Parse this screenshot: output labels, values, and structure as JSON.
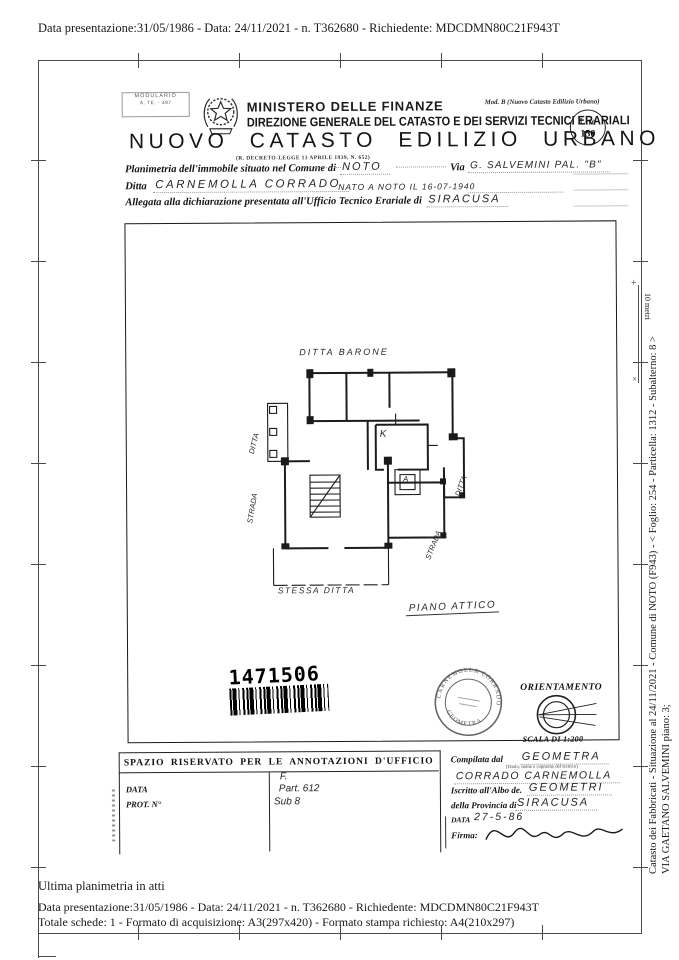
{
  "page": {
    "top_line": "Data presentazione:31/05/1986 - Data: 24/11/2021 - n. T362680 - Richiedente: MDCDMN80C21F943T",
    "bottom_line1": "Ultima planimetria in atti",
    "bottom_line2": "Data presentazione:31/05/1986 - Data: 24/11/2021 - n. T362680 - Richiedente: MDCDMN80C21F943T",
    "bottom_line3": "Totale schede: 1 - Formato di acquisizione: A3(297x420)  - Formato stampa richiesto: A4(210x297)",
    "margin_line1": "Catasto dei Fabbricati - Situazione al 24/11/2021 - Comune di NOTO (F943) - < Foglio: 254 - Particella: 1312 - Subalterno: 8 >",
    "margin_line2": "VIA GAETANO SALVEMINI piano: 3;",
    "margin_scale": "10 metri"
  },
  "header": {
    "modulario_line1": "MODULARIO",
    "modulario_line2": "A. TE. - 497",
    "ministry": "MINISTERO DELLE FINANZE",
    "direction": "DIREZIONE GENERALE DEL CATASTO E DEI SERVIZI TECNICI ERARIALI",
    "title": "NUOVO CATASTO EDILIZIO URBANO",
    "subtitle": "(R. DECRETO-LEGGE 13 APRILE 1939, N. 652)",
    "mod_b": "Mod. B (Nuovo Catasto Edilizio Urbano)",
    "lire_line1": "Lire",
    "lire_line2": "150"
  },
  "form": {
    "line1_label1": "Planimetria dell'immobile situato nel Comune di",
    "line1_value1": "NOTO",
    "line1_label2": "Via",
    "line1_value2": "G. SALVEMINI  PAL. \"B\"",
    "line2_label": "Ditta",
    "line2_value": "CARNEMOLLA  CORRADO",
    "line2_value_small": "NATO A NOTO IL 16-07-1940",
    "line3_label": "Allegata alla dichiarazione presentata all'Ufficio Tecnico Erariale di",
    "line3_value": "SIRACUSA"
  },
  "plan": {
    "label_top": "DITTA BARONE",
    "label_left_upper": "DITTA",
    "label_left_lower": "STRADA",
    "label_right_upper": "DITTA",
    "label_right_lower": "STRADA",
    "label_kitchen": "K",
    "label_elevator": "A",
    "label_bottom": "STESSA DITTA",
    "caption": "PIANO ATTICO",
    "barcode_number": "1471506",
    "orientation_label": "ORIENTAMENTO",
    "scale_label": "SCALA DI 1:200",
    "stamp_text_top": "CARNEMOLLA CORRADO",
    "stamp_text_bottom": "GEOMETRA"
  },
  "annotations": {
    "header": "SPAZIO RISERVATO PER LE ANNOTAZIONI D'UFFICIO",
    "label_data": "DATA",
    "label_prot": "PROT. N°",
    "hw_line1": "F.",
    "hw_line2": "Part. 612",
    "hw_line3": "Sub 8"
  },
  "compiler": {
    "label1": "Compilata dal",
    "value1": "GEOMETRA",
    "label1_small": "(Titolo, nome e cognome del tecnico)",
    "value1b": "CORRADO CARNEMOLLA",
    "label2": "Iscritto all'Albo de.",
    "value2": "GEOMETRI",
    "label3": "della Provincia di",
    "value3": "SIRACUSA",
    "label4": "DATA",
    "value4": "27-5-86",
    "label5": "Firma:"
  }
}
